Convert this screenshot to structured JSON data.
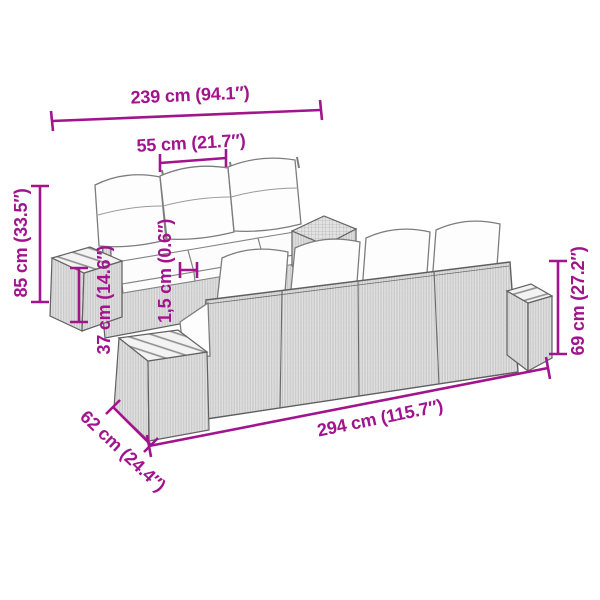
{
  "diagram": {
    "type": "product-dimension-diagram",
    "subject": "rattan garden lounge set with cushions and slatted side tables",
    "accent_color": "#A1148D",
    "background": "#ffffff",
    "dimensions": {
      "total_width": "239 cm (94.1″)",
      "seat_width": "55 cm (21.7″)",
      "total_height": "85 cm (33.5″)",
      "table_height": "37 cm (14.6″)",
      "cushion_thickness": "1,5 cm (0.6″)",
      "back_height": "69 cm (27.2″)",
      "total_length": "294 cm (115.7″)",
      "depth": "62 cm (24.4″)"
    }
  }
}
